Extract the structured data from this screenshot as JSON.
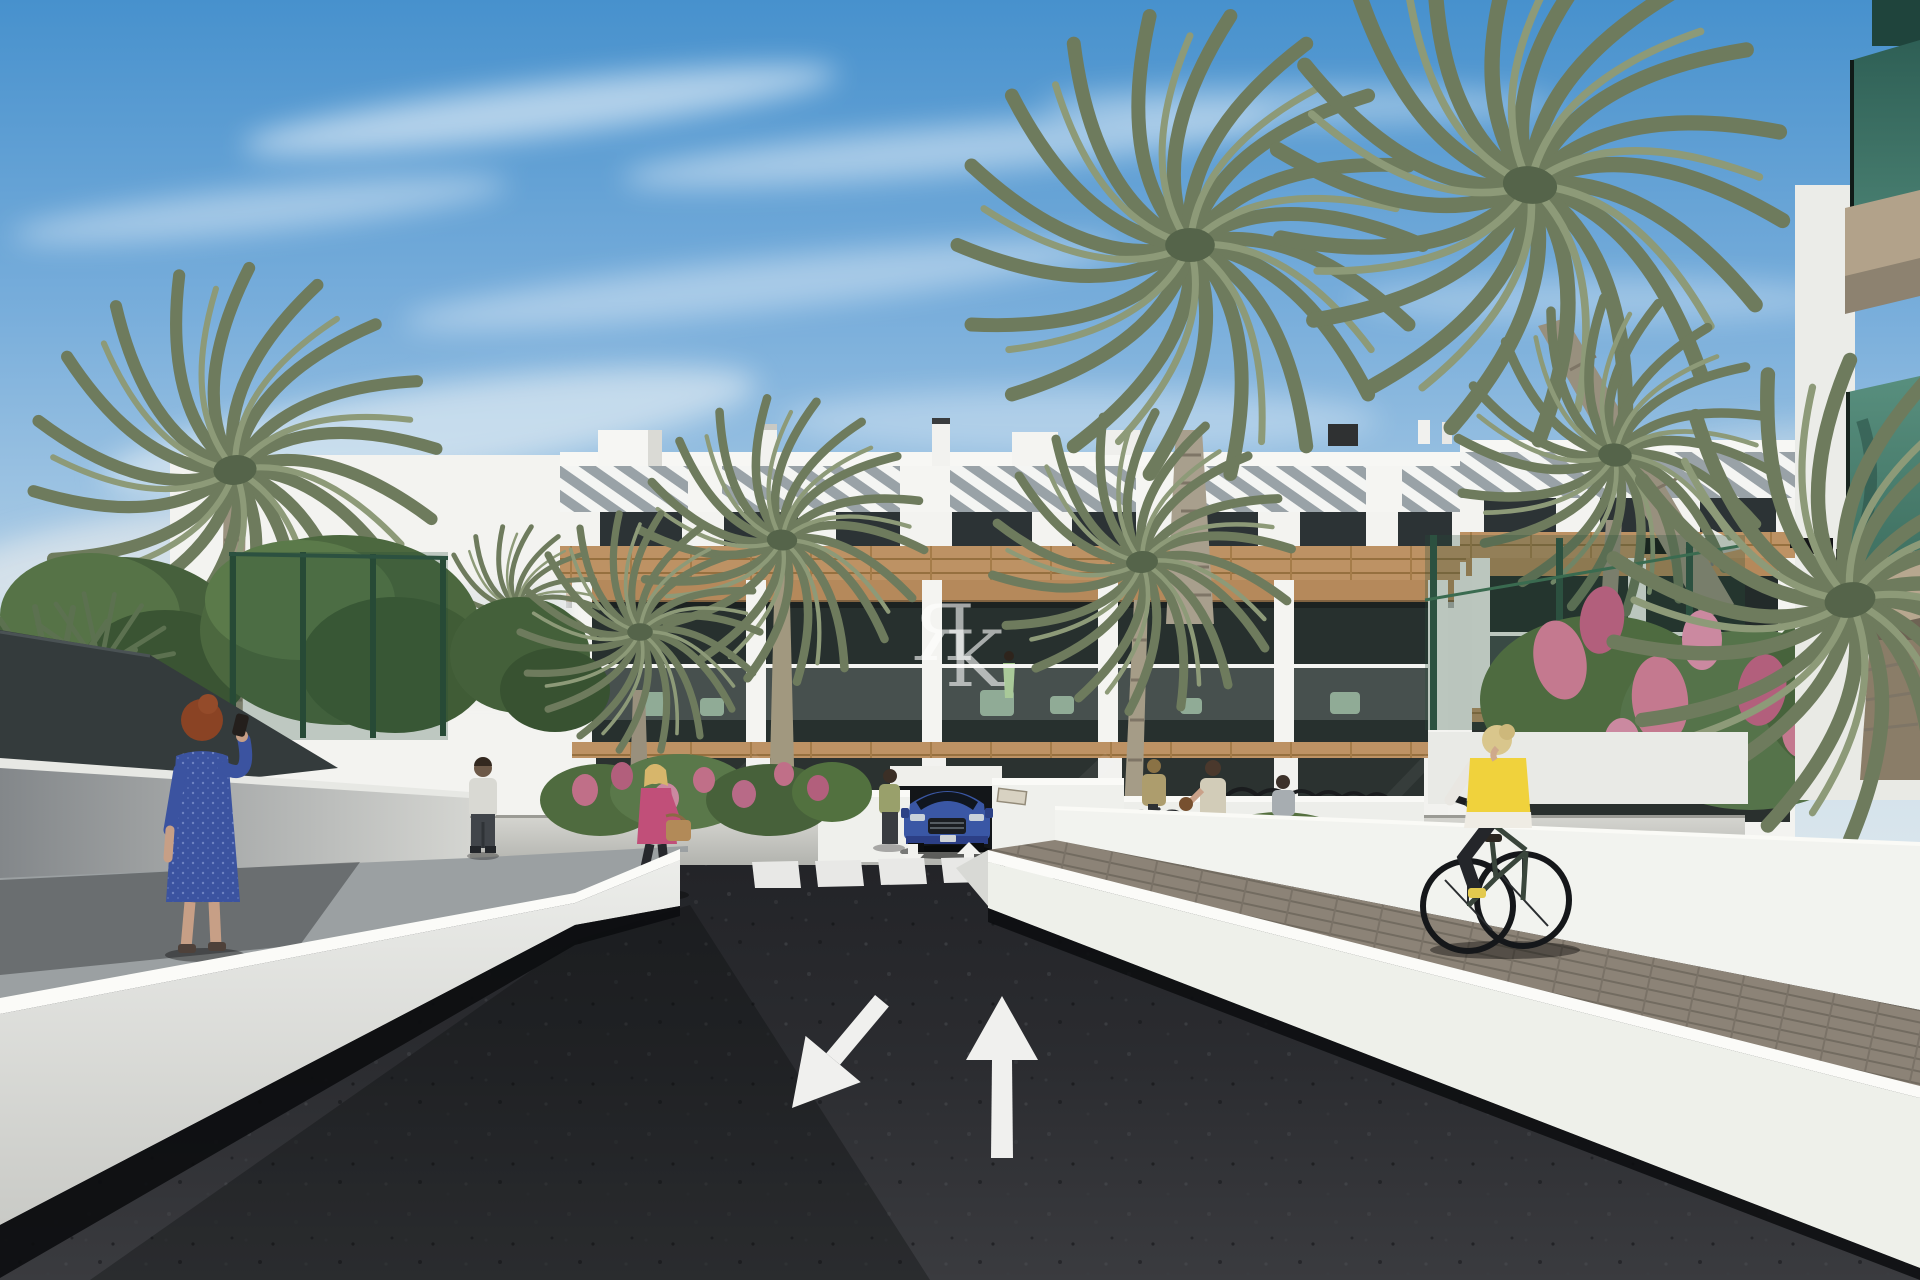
{
  "watermark": {
    "letters": [
      "Я",
      "K"
    ]
  },
  "scene": {
    "road_markings": {
      "large_arrows": [
        "down-left",
        "up"
      ],
      "small_arrows": [
        "down",
        "up"
      ],
      "crosswalk_stripe_count": 9
    },
    "palette": {
      "sky_top": "#4791cd",
      "sky_horizon": "#dde8ee",
      "asphalt": "#28292c",
      "building_white": "#f3f3f0",
      "wood_cladding": "#bd9264",
      "dark_glass": "#27302e",
      "balcony_glass_teal": "#3f7265",
      "palm_green": "#6e7b5d",
      "fence_green": "#2c5140",
      "flower_pink": "#c06f88",
      "vest_yellow": "#f0d23c",
      "car_blue": "#3a57a5",
      "dress_blue": "#3b53a0",
      "jacket_pink": "#c14f79",
      "wall_white": "#eef0ea"
    }
  }
}
